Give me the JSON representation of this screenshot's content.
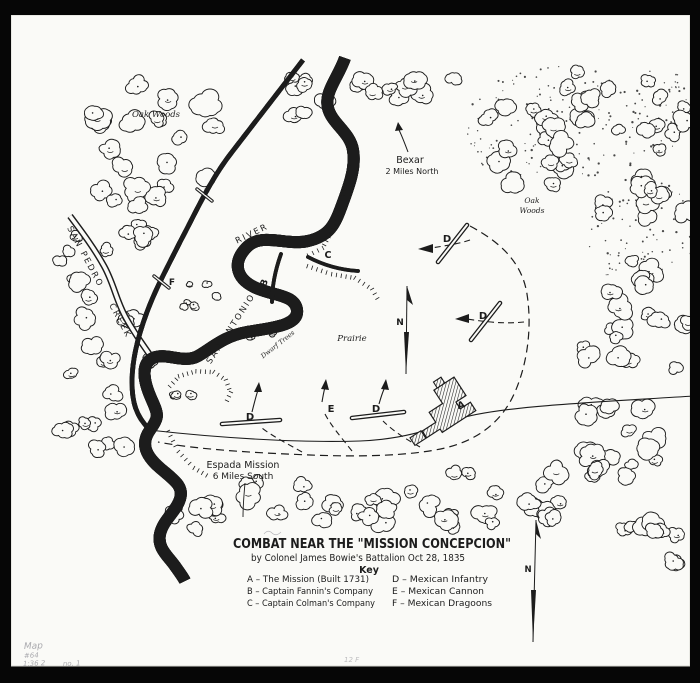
{
  "colors": {
    "photo_background": "#060606",
    "paper": "#fafaf7",
    "ink": "#1c1c1c",
    "pencil": "#9b9ba1"
  },
  "map": {
    "labels": {
      "oak_woods_left": "Oak Woods",
      "oak_right_1": "Oak",
      "oak_right_2": "Woods",
      "bexar_1": "Bexar",
      "bexar_2": "2 Miles North",
      "san_pedro": "SAN PEDRO",
      "creek": "CREEK",
      "san_antonio": "SAN ANTONIO",
      "river": "RIVER",
      "dwarf_trees": "Dwarf Trees",
      "prairie": "Prairie",
      "espada_1": "Espada Mission",
      "espada_2": "6 Miles South",
      "north": "N"
    },
    "markers": [
      {
        "letter": "A",
        "meaning": "The Mission"
      },
      {
        "letter": "B",
        "meaning": "Captain Fannin's Company"
      },
      {
        "letter": "C",
        "meaning": "Captain Colman's Company"
      },
      {
        "letter": "D",
        "meaning": "Mexican Infantry"
      },
      {
        "letter": "D",
        "meaning": "Mexican Infantry"
      },
      {
        "letter": "D",
        "meaning": "Mexican Infantry"
      },
      {
        "letter": "D",
        "meaning": "Mexican Infantry"
      },
      {
        "letter": "E",
        "meaning": "Mexican Cannon"
      },
      {
        "letter": "F",
        "meaning": "Mexican Dragoons"
      },
      {
        "letter": "F",
        "meaning": "Mexican Dragoons"
      }
    ]
  },
  "title_block": {
    "title": "COMBAT NEAR THE \"MISSION CONCEPCION\"",
    "subtitle": "by Colonel James Bowie's Battalion  Oct 28, 1835",
    "key_heading": "Key",
    "key_left": [
      "A – The Mission (Built 1731)",
      "B – Captain Fannin's Company",
      "C – Captain Colman's Company"
    ],
    "key_right": [
      "D – Mexican Infantry",
      "E – Mexican Cannon",
      "F – Mexican Dragoons"
    ]
  },
  "pencil_notes": {
    "line1": "Map",
    "line2": "#64",
    "line3": "1:36 2",
    "line4": "no. 1",
    "center": "12 F"
  }
}
